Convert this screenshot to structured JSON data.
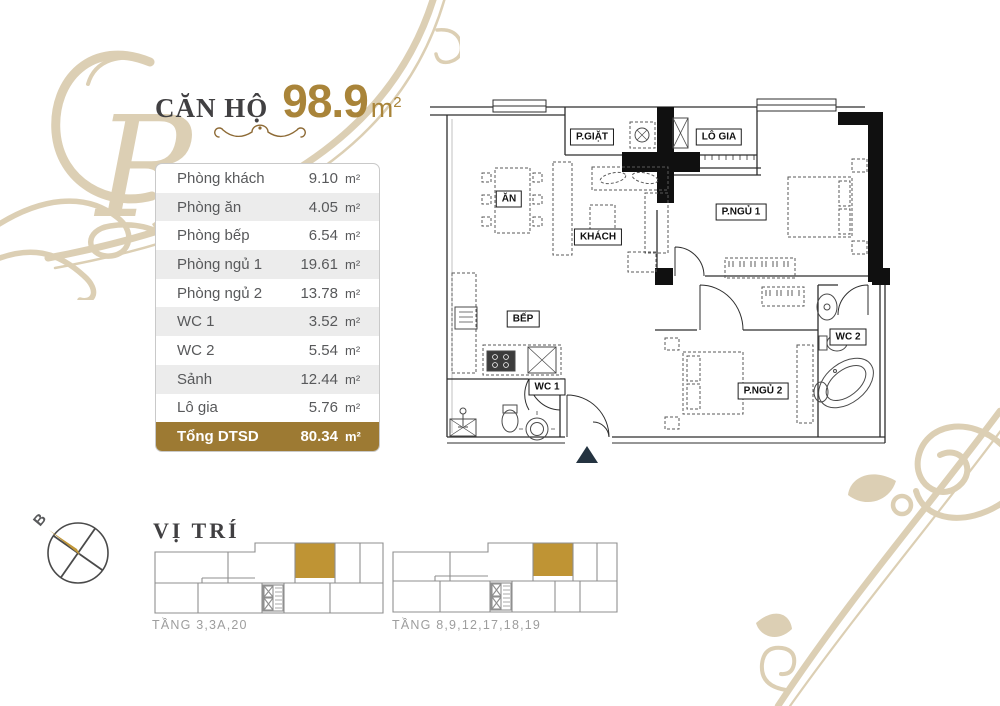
{
  "header": {
    "title_label": "CĂN HỘ",
    "title_value": "98.9",
    "title_unit": "m",
    "title_unit_exp": "2"
  },
  "area_table": {
    "unit": "m²",
    "rows": [
      {
        "label": "Phòng khách",
        "value": "9.10"
      },
      {
        "label": "Phòng ăn",
        "value": "4.05"
      },
      {
        "label": "Phòng bếp",
        "value": "6.54"
      },
      {
        "label": "Phòng ngủ 1",
        "value": "19.61"
      },
      {
        "label": "Phòng ngủ 2",
        "value": "13.78"
      },
      {
        "label": "WC 1",
        "value": "3.52"
      },
      {
        "label": "WC 2",
        "value": "5.54"
      },
      {
        "label": "Sảnh",
        "value": "12.44"
      },
      {
        "label": "Lô gia",
        "value": "5.76"
      }
    ],
    "total_label": "Tổng DTSD",
    "total_value": "80.34"
  },
  "floor_plan": {
    "rooms": {
      "laundry": "P.GIẶT",
      "loggia": "LÔ GIA",
      "dining": "ĂN",
      "living": "KHÁCH",
      "bedroom1": "P.NGỦ 1",
      "kitchen": "BẾP",
      "wc1": "WC 1",
      "wc2": "WC 2",
      "bedroom2": "P.NGỦ 2"
    }
  },
  "location": {
    "heading": "VỊ TRÍ",
    "compass_label": "B",
    "floor_groups": [
      "TẦNG 3,3A,20",
      "TẦNG 8,9,12,17,18,19"
    ]
  },
  "colors": {
    "accent_gold": "#a98439",
    "total_row_bg": "#9d7a33",
    "highlight_unit": "#bf9434",
    "ornament_beige": "#dccfb4",
    "text_dark": "#414042",
    "text_gray": "#58595b",
    "label_gray": "#9d9d9d",
    "entrance_marker": "#243340"
  }
}
